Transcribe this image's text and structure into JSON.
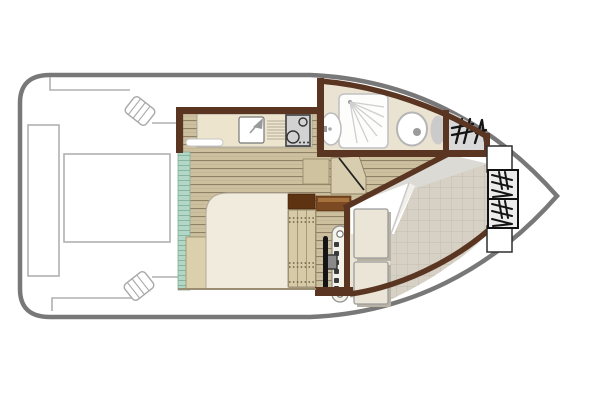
{
  "meta": {
    "title": "Houseboat deck plan",
    "description": "Top-down floor plan of a small canal cruiser, bow pointing right",
    "visible_text": "none"
  },
  "palette": {
    "hull_outline": "#787878",
    "deck_thin_lines": "#b0b0b0",
    "cabin_wall_brown": "#5a3622",
    "wood_floor": "#ccc0a0",
    "wood_floor_line": "#8e8166",
    "sliding_door_teal": "#b2d7c6",
    "bathroom_floor": "#eae3d2",
    "cockpit_tile": "#d6d0c5",
    "cockpit_gray": "#dbdad4",
    "bed_duvet": "#f0ebdc",
    "bed_base": "#dccfab",
    "counter": "#ece4cd",
    "stove_panel": "#d2d2d2",
    "cushion": "#eae5d6",
    "cabinet_dark": "#5e3312",
    "cabinet_light": "#7b4a22",
    "locker_fill": "#ececec",
    "glyph_black": "#141414"
  },
  "rooms": {
    "stern_deck": {
      "label": "Stern sun deck"
    },
    "cabin": {
      "label": "Main cabin with double bed"
    },
    "galley": {
      "label": "Galley kitchenette"
    },
    "shower_room": {
      "label": "Shower room with washbasin and WC"
    },
    "helm": {
      "label": "Helm station with steering wheel"
    },
    "bow_cockpit": {
      "label": "Bow cockpit with seat cushions"
    },
    "chair_store": {
      "label": "Deck chair store"
    }
  },
  "fixtures": {
    "sun_pad": {
      "label": "Sun pad outline on stern deck"
    },
    "side_bench": {
      "label": "Side bench outline"
    },
    "cleats": {
      "label": "Folding deck cleat",
      "count": 2
    },
    "sliding_door": {
      "label": "Teal sliding patio door"
    },
    "kitchen_sink": {
      "label": "Galley sink with tap"
    },
    "drainboard": {
      "label": "Drainboard"
    },
    "stove": {
      "label": "Two-burner hob",
      "burners": 2
    },
    "shelf": {
      "label": "Shelf under counter"
    },
    "double_bed": {
      "label": "Double bed with duvet"
    },
    "step_chest": {
      "label": "Step chest by companionway"
    },
    "companionway_door": {
      "label": "Door to cockpit (shown open)"
    },
    "cabinets": {
      "label": "Storage cabinets",
      "count": 2
    },
    "steps": {
      "label": "Tread strip with anti-slip dots"
    },
    "steering_wheel": {
      "label": "Steering wheel"
    },
    "instrument_console": {
      "label": "Instrument console with buttons and gauges"
    },
    "shower": {
      "label": "Shower tray with spray"
    },
    "washbasin": {
      "label": "Oval washbasin"
    },
    "toilet": {
      "label": "Marine toilet with cistern"
    },
    "seat_cushions": {
      "label": "Cockpit seat cushion",
      "count": 2
    },
    "folded_canvas": {
      "label": "Folded white canvas/table cloth"
    },
    "deck_chair_icons": {
      "label": "Folding deck chair symbol",
      "count": 3
    },
    "bow_lockers": {
      "label": "Bow locker box with deck chair symbol",
      "count": 2
    },
    "bow_shelves": {
      "label": "Open bow shelf outline",
      "count": 2
    }
  }
}
